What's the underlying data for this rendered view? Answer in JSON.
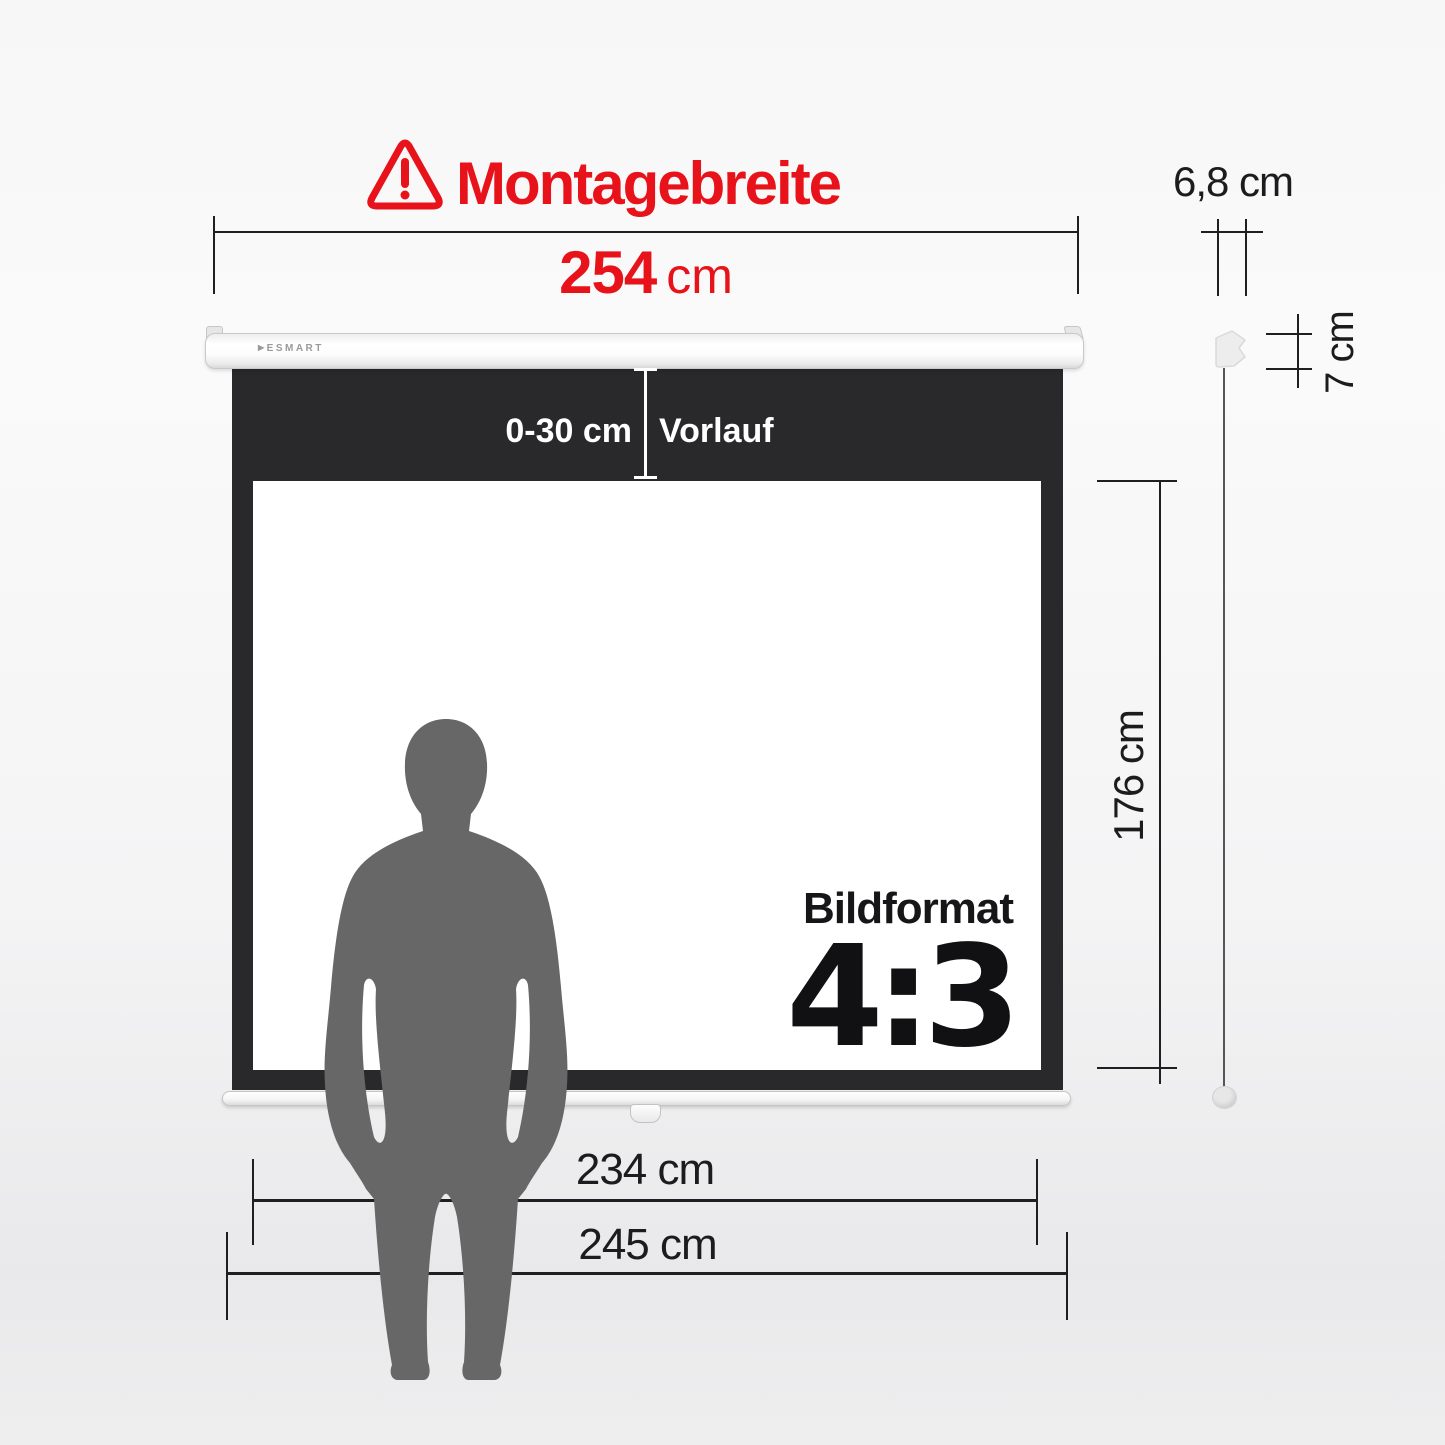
{
  "top_dimension": {
    "title": "Montagebreite",
    "value": "254",
    "unit": "cm"
  },
  "width_dimension": {
    "label": "6,8 cm"
  },
  "depth_dimension": {
    "label": "7 cm"
  },
  "height_dimension": {
    "label": "176 cm"
  },
  "vorlauf": {
    "range": "0-30 cm",
    "label": "Vorlauf"
  },
  "screen": {
    "brand_mark": "▶",
    "brand": "ESMART",
    "format_label": "Bildformat",
    "format_value": "4:3"
  },
  "bottom_dimensions": {
    "fabric_width": "234 cm",
    "case_width": "245 cm"
  },
  "colors": {
    "accent_red": "#e8121a",
    "ink": "#1c1c1e",
    "curtain_black": "#29292b",
    "silhouette_gray": "#676767"
  }
}
